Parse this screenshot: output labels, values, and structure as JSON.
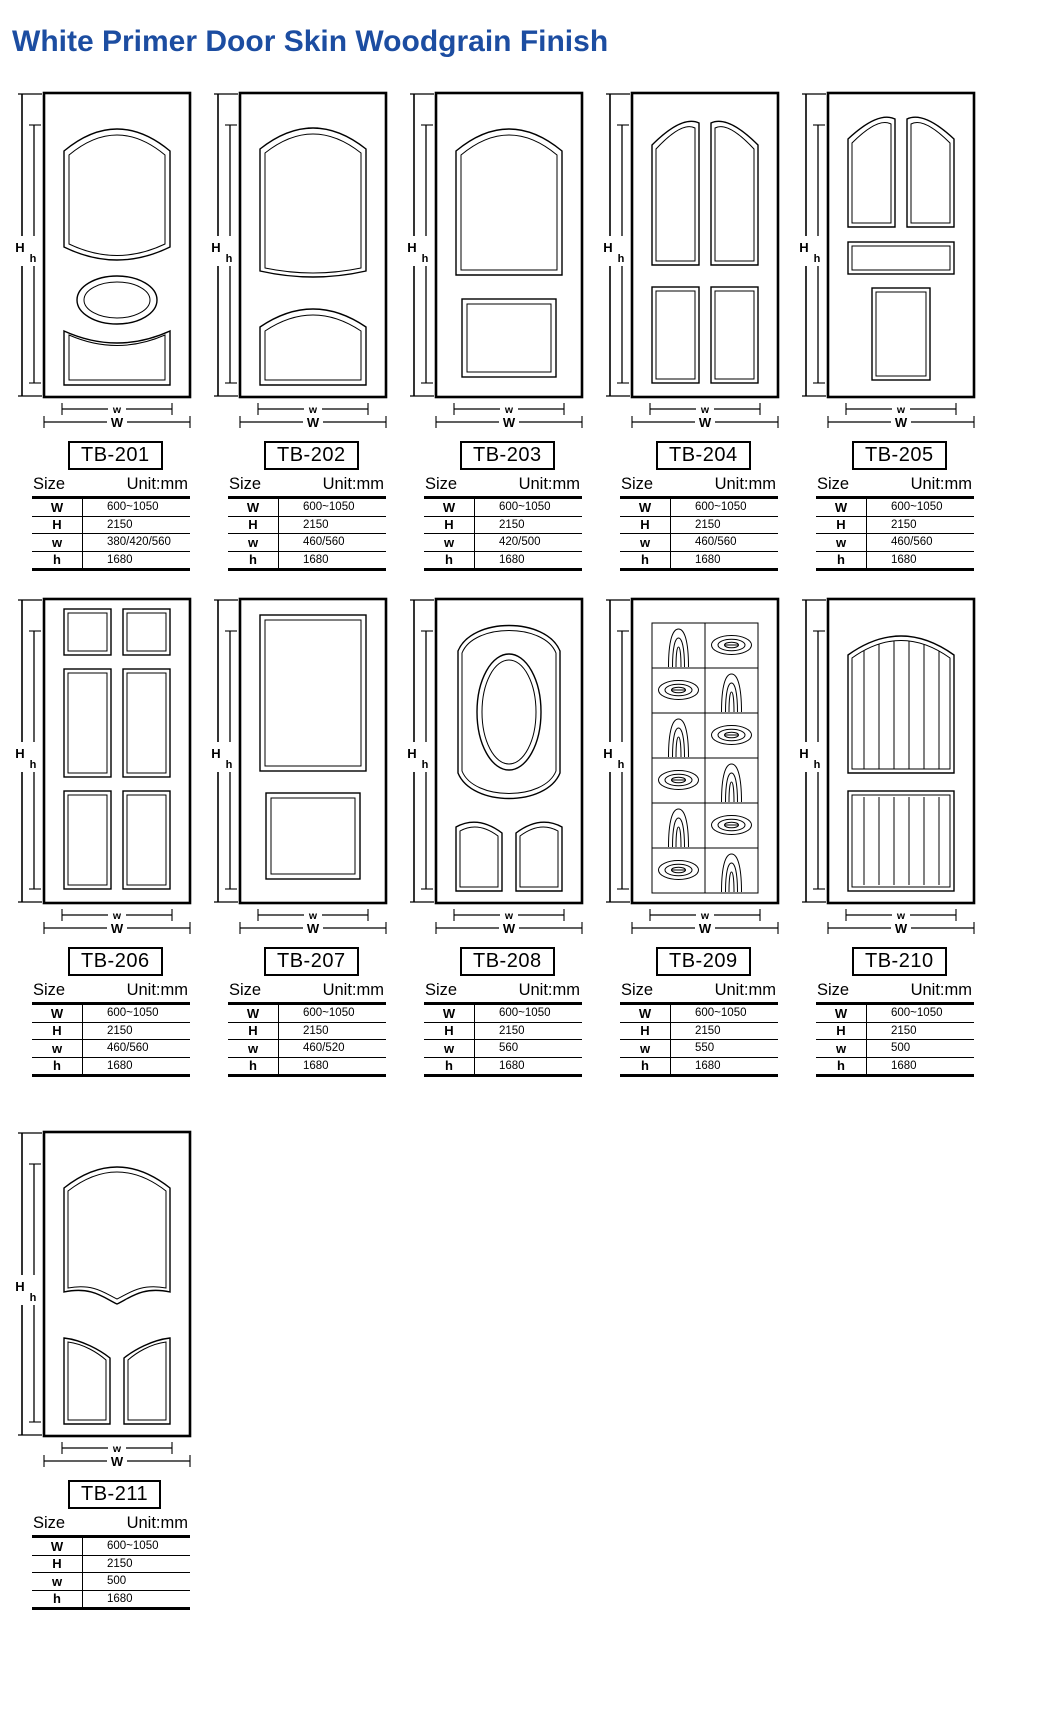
{
  "page": {
    "title": "White Primer Door Skin Woodgrain Finish"
  },
  "colors": {
    "title_blue": "#1c4da1",
    "line_black": "#000000"
  },
  "table_header": {
    "size_label": "Size",
    "unit_label": "Unit:mm"
  },
  "row_labels": [
    "W",
    "H",
    "w",
    "h"
  ],
  "dim_labels": {
    "H": "H",
    "h": "h",
    "W": "W",
    "w": "w"
  },
  "doors": [
    {
      "model": "TB-201",
      "W": "600~1050",
      "H": "2150",
      "w": "380/420/560",
      "h": "1680"
    },
    {
      "model": "TB-202",
      "W": "600~1050",
      "H": "2150",
      "w": "460/560",
      "h": "1680"
    },
    {
      "model": "TB-203",
      "W": "600~1050",
      "H": "2150",
      "w": "420/500",
      "h": "1680"
    },
    {
      "model": "TB-204",
      "W": "600~1050",
      "H": "2150",
      "w": "460/560",
      "h": "1680"
    },
    {
      "model": "TB-205",
      "W": "600~1050",
      "H": "2150",
      "w": "460/560",
      "h": "1680"
    },
    {
      "model": "TB-206",
      "W": "600~1050",
      "H": "2150",
      "w": "460/560",
      "h": "1680"
    },
    {
      "model": "TB-207",
      "W": "600~1050",
      "H": "2150",
      "w": "460/520",
      "h": "1680"
    },
    {
      "model": "TB-208",
      "W": "600~1050",
      "H": "2150",
      "w": "560",
      "h": "1680"
    },
    {
      "model": "TB-209",
      "W": "600~1050",
      "H": "2150",
      "w": "550",
      "h": "1680"
    },
    {
      "model": "TB-210",
      "W": "600~1050",
      "H": "2150",
      "w": "500",
      "h": "1680"
    },
    {
      "model": "TB-211",
      "W": "600~1050",
      "H": "2150",
      "w": "500",
      "h": "1680"
    }
  ]
}
